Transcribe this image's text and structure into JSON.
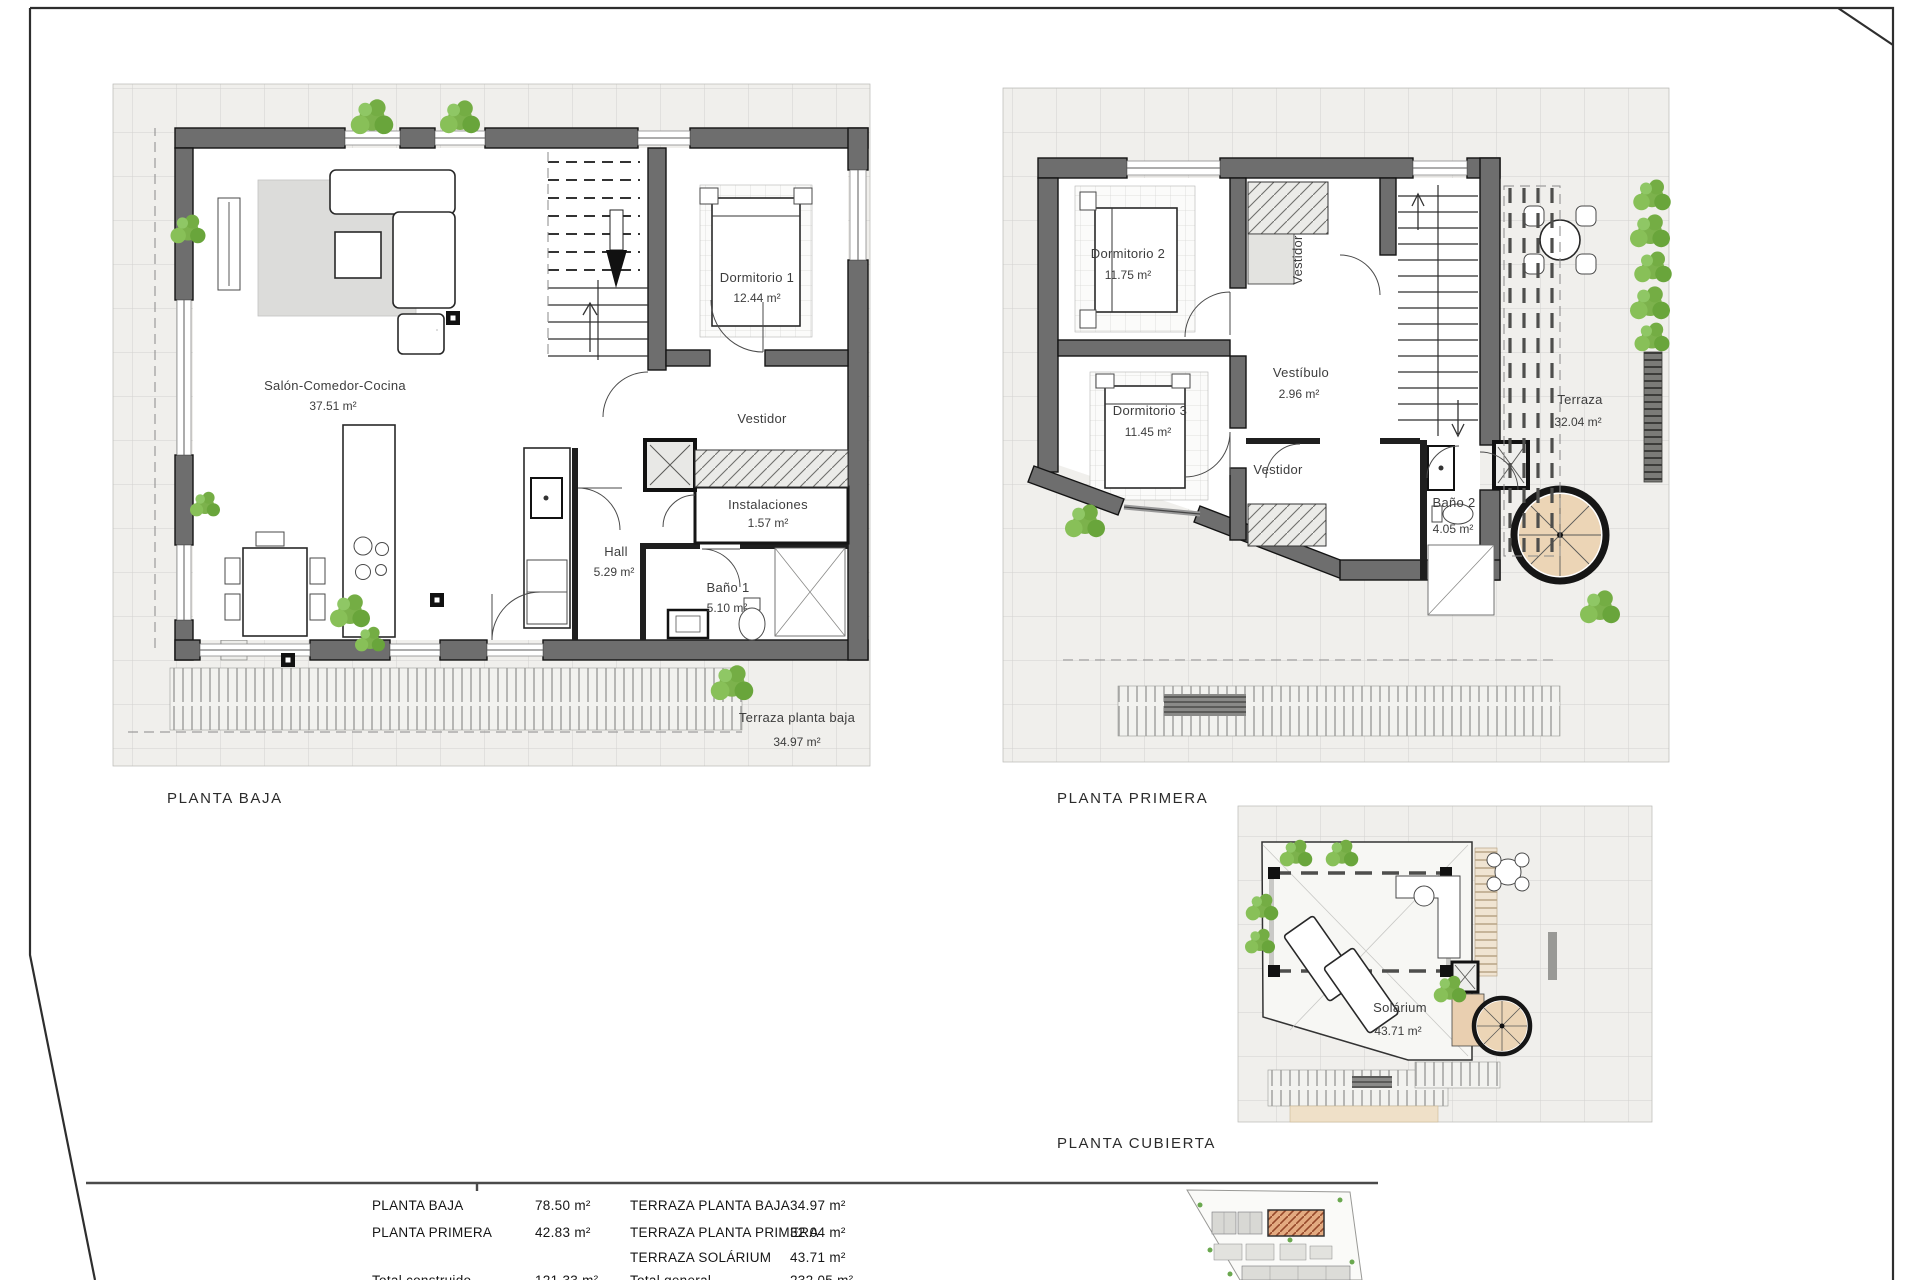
{
  "sheet": {
    "plans": {
      "baja": {
        "title": "PLANTA BAJA",
        "rooms": {
          "salon": {
            "name": "Salón-Comedor-Cocina",
            "area": "37.51 m²"
          },
          "dormitorio1": {
            "name": "Dormitorio 1",
            "area": "12.44 m²"
          },
          "vestidor": {
            "name": "Vestidor"
          },
          "instalaciones": {
            "name": "Instalaciones",
            "area": "1.57 m²"
          },
          "hall": {
            "name": "Hall",
            "area": "5.29 m²"
          },
          "bano1": {
            "name": "Baño 1",
            "area": "5.10 m²"
          },
          "terraza": {
            "name": "Terraza planta baja",
            "area": "34.97 m²"
          }
        }
      },
      "primera": {
        "title": "PLANTA PRIMERA",
        "rooms": {
          "dormitorio2": {
            "name": "Dormitorio 2",
            "area": "11.75 m²"
          },
          "dormitorio3": {
            "name": "Dormitorio 3",
            "area": "11.45 m²"
          },
          "vestidor_top": {
            "name": "Vestidor"
          },
          "vestibulo": {
            "name": "Vestíbulo",
            "area": "2.96 m²"
          },
          "vestidor_bajo": {
            "name": "Vestidor"
          },
          "bano2": {
            "name": "Baño 2",
            "area": "4.05 m²"
          },
          "terraza": {
            "name": "Terraza",
            "area": "32.04 m²"
          }
        }
      },
      "cubierta": {
        "title": "PLANTA CUBIERTA",
        "rooms": {
          "solarium": {
            "name": "Solárium",
            "area": "43.71 m²"
          }
        }
      }
    },
    "summary": {
      "rows": [
        {
          "c1": "PLANTA BAJA",
          "v1": "78.50 m²",
          "c2": "TERRAZA PLANTA BAJA",
          "v2": "34.97 m²"
        },
        {
          "c1": "PLANTA PRIMERA",
          "v1": "42.83 m²",
          "c2": "TERRAZA PLANTA PRIMERA",
          "v2": "32.04 m²"
        },
        {
          "c1": "",
          "v1": "",
          "c2": "TERRAZA SOLÁRIUM",
          "v2": "43.71 m²"
        },
        {
          "c1": "Total construido",
          "v1": "121.33 m²",
          "c2": "Total general",
          "v2": "232.05 m²"
        }
      ]
    },
    "watermark": "BH",
    "colors": {
      "wall_gray": "#6e6e6e",
      "tile_line": "#d2d2cf",
      "plant_green": "#7cb24c",
      "stair_beige": "#e9cfb0",
      "site_highlight": "#e3aa80"
    }
  }
}
